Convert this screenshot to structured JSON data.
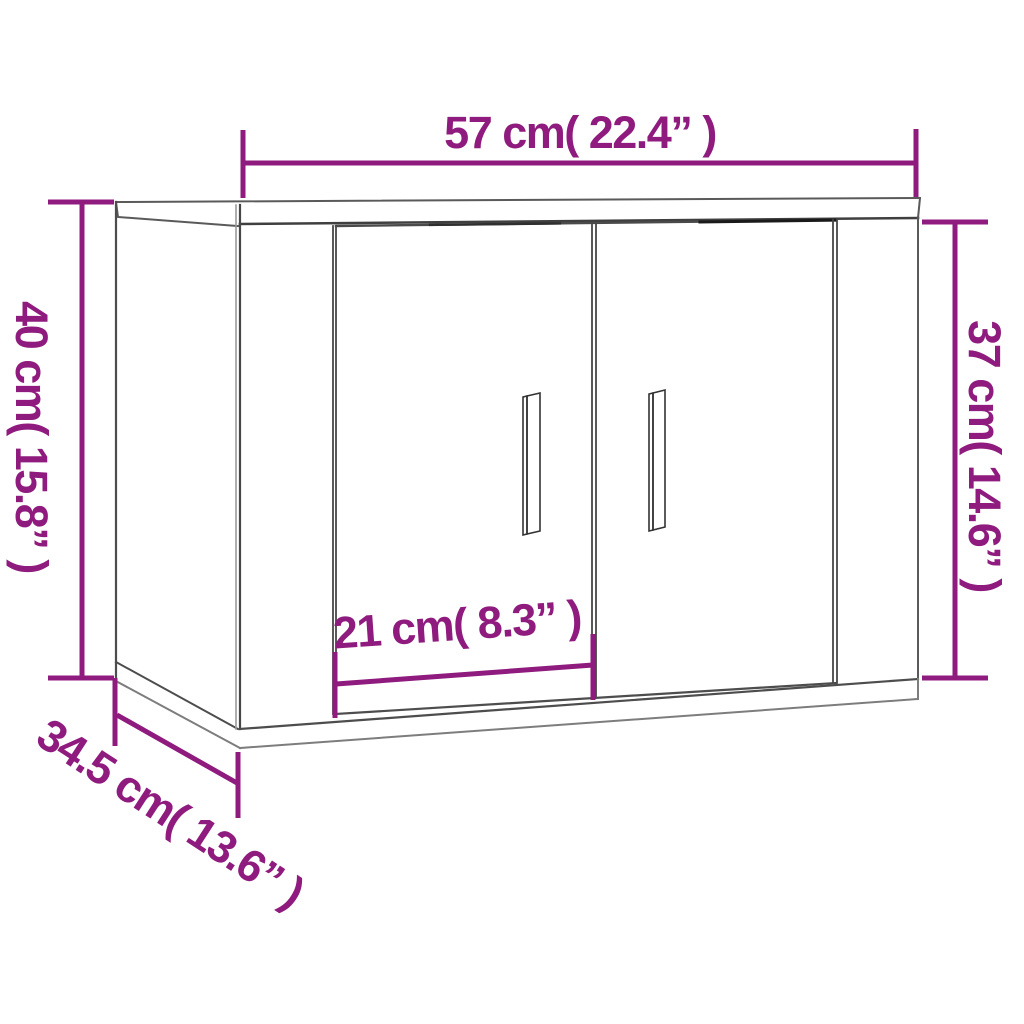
{
  "page": {
    "background_color": "#ffffff",
    "kind": "product dimension diagram",
    "subject": "wall-mounted cabinet with two doors, 3d line drawing"
  },
  "diagram": {
    "accent_color": "#8e1b7d",
    "line_color": "#4d4d4d",
    "dimensions": {
      "width": {
        "cm": "57",
        "inches": "22.4",
        "text": "57 cm( 22.4” )"
      },
      "height_left": {
        "cm": "40",
        "inches": "15.8",
        "text": "40 cm( 15.8” )"
      },
      "height_right": {
        "cm": "37",
        "inches": "14.6",
        "text": "37 cm( 14.6” )"
      },
      "door_width": {
        "cm": "21",
        "inches": "8.3",
        "text": "21 cm( 8.3” )"
      },
      "depth": {
        "cm": "34.5",
        "inches": "13.6",
        "text": "34.5 cm( 13.6” )"
      }
    }
  }
}
